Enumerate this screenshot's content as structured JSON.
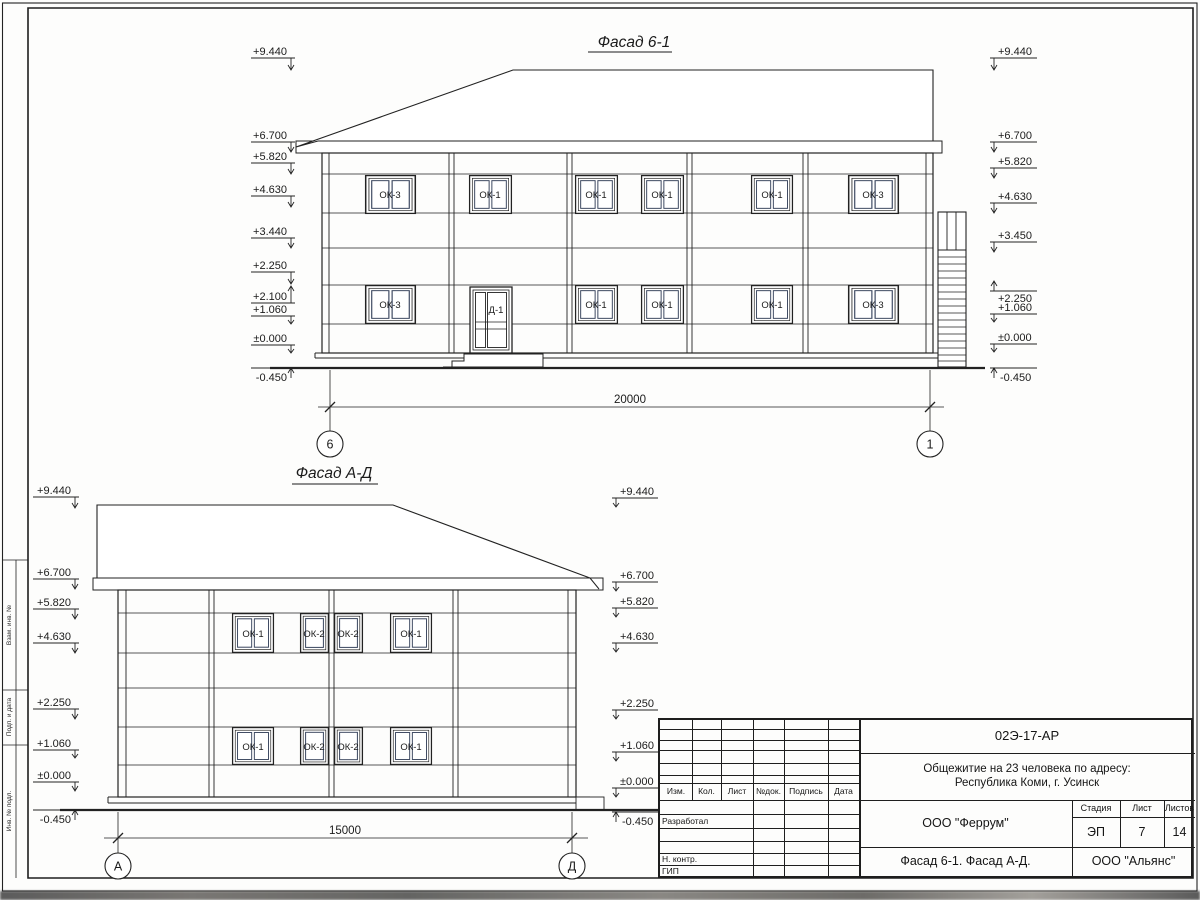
{
  "f1": {
    "title": "Фасад 6-1",
    "ml": [
      "+9.440",
      "+6.700",
      "+5.820",
      "+4.630",
      "+3.440",
      "+2.250",
      "+2.100",
      "+1.060",
      "±0.000",
      "-0.450"
    ],
    "mr": [
      "+9.440",
      "+6.700",
      "+5.820",
      "+4.630",
      "+3.450",
      "+2.250",
      "+1.060",
      "±0.000",
      "-0.450"
    ],
    "wu": [
      "ОК-3",
      "ОК-1",
      "ОК-1",
      "ОК-1",
      "ОК-1",
      "ОК-3"
    ],
    "wl": [
      "ОК-3",
      "ОК-1",
      "ОК-1",
      "ОК-1",
      "ОК-3"
    ],
    "door": "Д-1",
    "dim": "20000",
    "ax_l": "6",
    "ax_r": "1"
  },
  "f2": {
    "title": "Фасад А-Д",
    "ml": [
      "+9.440",
      "+6.700",
      "+5.820",
      "+4.630",
      "+2.250",
      "+1.060",
      "±0.000",
      "-0.450"
    ],
    "mr": [
      "+9.440",
      "+6.700",
      "+5.820",
      "+4.630",
      "+2.250",
      "+1.060",
      "±0.000",
      "-0.450"
    ],
    "wu": [
      "ОК-1",
      "ОК-2",
      "ОК-2",
      "ОК-1"
    ],
    "wl": [
      "ОК-1",
      "ОК-2",
      "ОК-2",
      "ОК-1"
    ],
    "dim": "15000",
    "ax_l": "А",
    "ax_r": "Д"
  },
  "tb": {
    "doc": "02Э-17-АР",
    "proj1": "Общежитие на 23 человека по адресу:",
    "proj2": "Республика Коми, г. Усинск",
    "cols": [
      "Изм.",
      "Кол.",
      "Лист",
      "№док.",
      "Подпись",
      "Дата"
    ],
    "r_razrab": "Разработал",
    "r_nkontr": "Н. контр.",
    "r_gip": "ГИП",
    "company": "ООО \"Феррум\"",
    "stage_l": "Стадия",
    "stage": "ЭП",
    "sheet_l": "Лист",
    "sheet": "7",
    "sheets_l": "Листов",
    "sheets": "14",
    "content": "Фасад 6-1. Фасад  А-Д.",
    "company2": "ООО \"Альянс\""
  },
  "frame": {
    "s1": "Взам. инв. №",
    "s2": "Подп. и дата",
    "s3": "Инв. № подл."
  }
}
